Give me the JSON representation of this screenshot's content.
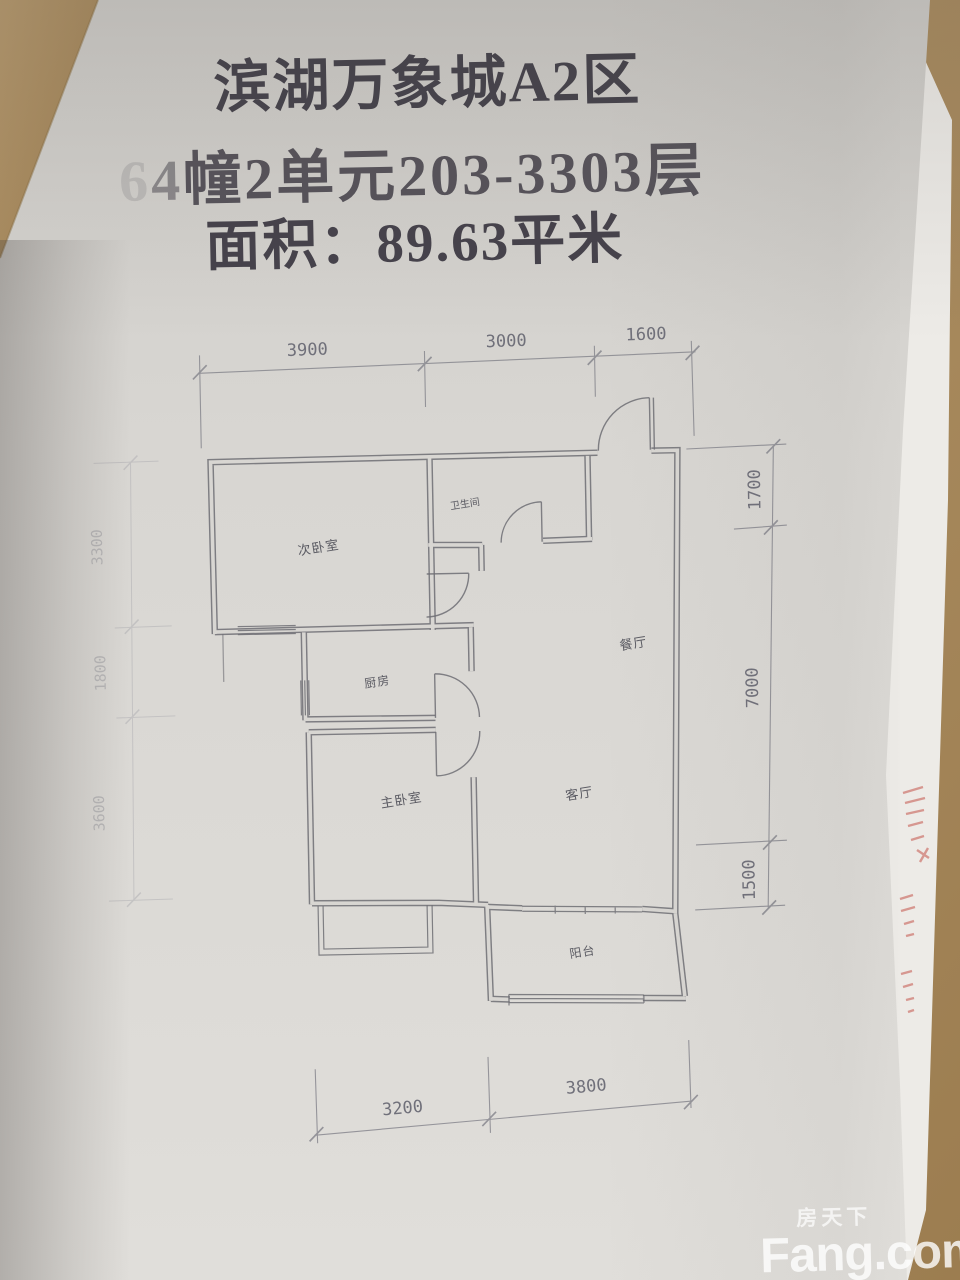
{
  "title": {
    "line1": "滨湖万象城A2区",
    "line2_faded": "6",
    "line2_semi": "4",
    "line2_rest": "幢2单元203-3303层",
    "line3": "面积：89.63平米"
  },
  "plan": {
    "rooms": {
      "secondary_bedroom": "次卧室",
      "bathroom": "卫生间",
      "kitchen": "厨房",
      "master_bedroom": "主卧室",
      "living_room": "客厅",
      "dining_room": "餐厅",
      "balcony": "阳台"
    },
    "dims": {
      "top": [
        "3900",
        "3000",
        "1600"
      ],
      "right": [
        "1700",
        "7000",
        "1500"
      ],
      "bottom": [
        "3200",
        "3800"
      ],
      "left": [
        "3300",
        "1800",
        "3600"
      ]
    }
  },
  "watermark": {
    "cn": "房天下",
    "en": "Fang.com"
  },
  "colors": {
    "paper": "#d8d6d2",
    "under_paper": "#edebe7",
    "wood": "#ac8e62",
    "ink": "#45424b",
    "wall": "#6e6e74",
    "dim": "#83838b",
    "stamp": "#c4544a",
    "watermark": "#ffffff"
  }
}
